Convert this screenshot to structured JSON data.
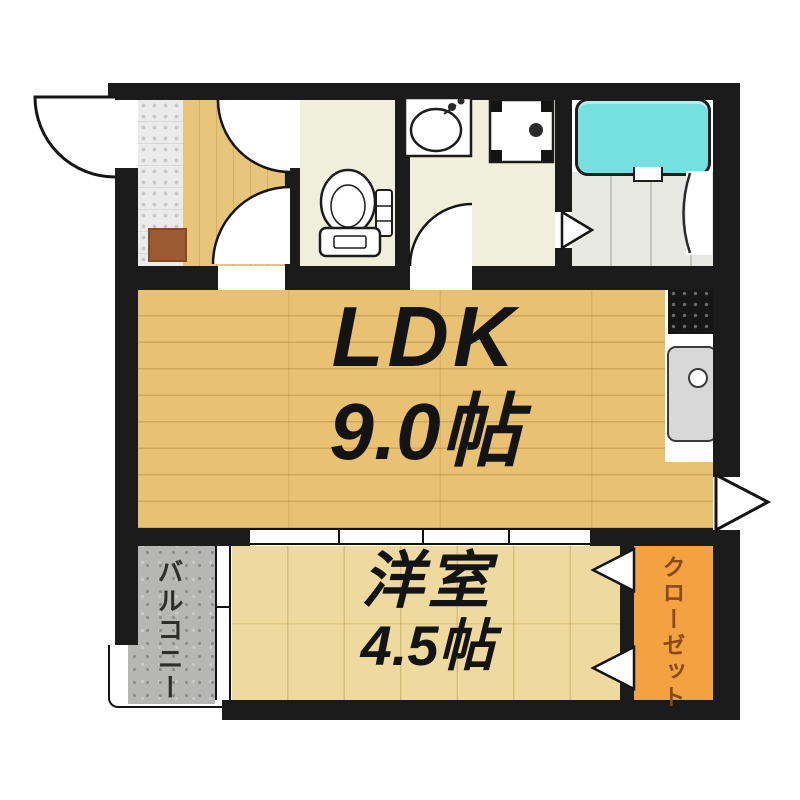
{
  "title": "間取り図",
  "rooms": {
    "ldk": {
      "label": "LDK",
      "size": "9.0帖"
    },
    "bedroom": {
      "label": "洋室",
      "size": "4.5帖"
    },
    "balcony": {
      "label": "バルコニー"
    },
    "closet": {
      "label": "クローゼット"
    }
  },
  "colors": {
    "wall": "#1b1b1b",
    "ldk-floor": "#e8c172",
    "hall-floor": "#e7c57b",
    "bedroom-floor": "#eeda9e",
    "service-floor": "#f0efdb",
    "bath-floor": "#e8e8e3",
    "balcony-floor": "#b6b6b4",
    "entry-tile": "#ebebeb",
    "closet": "#f3a242",
    "closet-text": "#8a4a15",
    "balcony-text": "#2e2e2e",
    "tub": "#76dfe0",
    "sink": "#d8d8d8",
    "shoe": "#9c5a33"
  }
}
